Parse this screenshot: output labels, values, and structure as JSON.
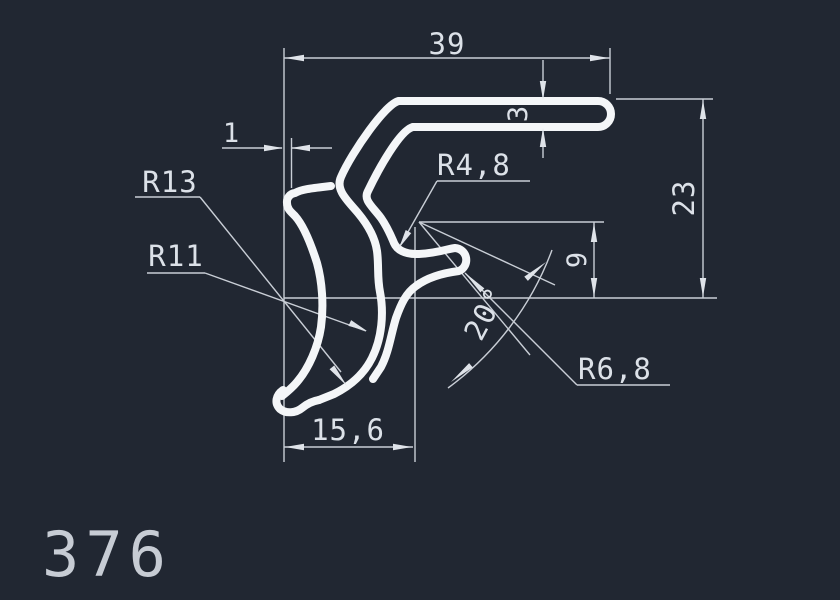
{
  "drawing": {
    "part_number": "376",
    "dimensions": {
      "top_width": "39",
      "wall_thickness": "3",
      "lip_offset": "1",
      "overall_height": "23",
      "hook_drop": "9",
      "bottom_width": "15,6",
      "angle": "20°"
    },
    "radii": {
      "r13": "R13",
      "r11": "R11",
      "r4_8": "R4,8",
      "r6_8": "R6,8"
    },
    "colors": {
      "background": "#212732",
      "profile_line": "#f4f6f8",
      "dimension_line": "#c9ced6",
      "text": "#dce1e8"
    }
  }
}
